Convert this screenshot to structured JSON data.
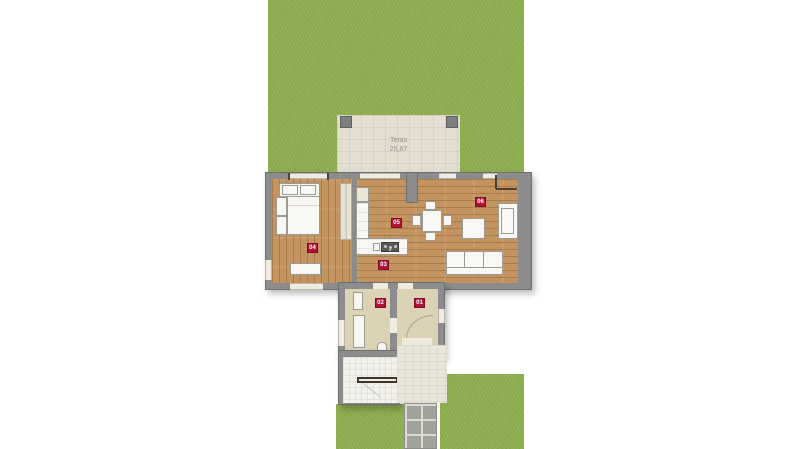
{
  "plan": {
    "terrace": {
      "label": "Teras",
      "area": "25,67"
    },
    "rooms": [
      {
        "id": "01"
      },
      {
        "id": "02"
      },
      {
        "id": "03"
      },
      {
        "id": "04"
      },
      {
        "id": "05"
      },
      {
        "id": "06"
      }
    ],
    "colors": {
      "lawn_green": "#8fb14f",
      "wall_gray": "#8c8c8c",
      "wood_floor": "#c3945f",
      "tile_floor": "#dcd2b6",
      "terrace_cream": "#e3ded0",
      "badge_crimson": "#b21238"
    }
  }
}
